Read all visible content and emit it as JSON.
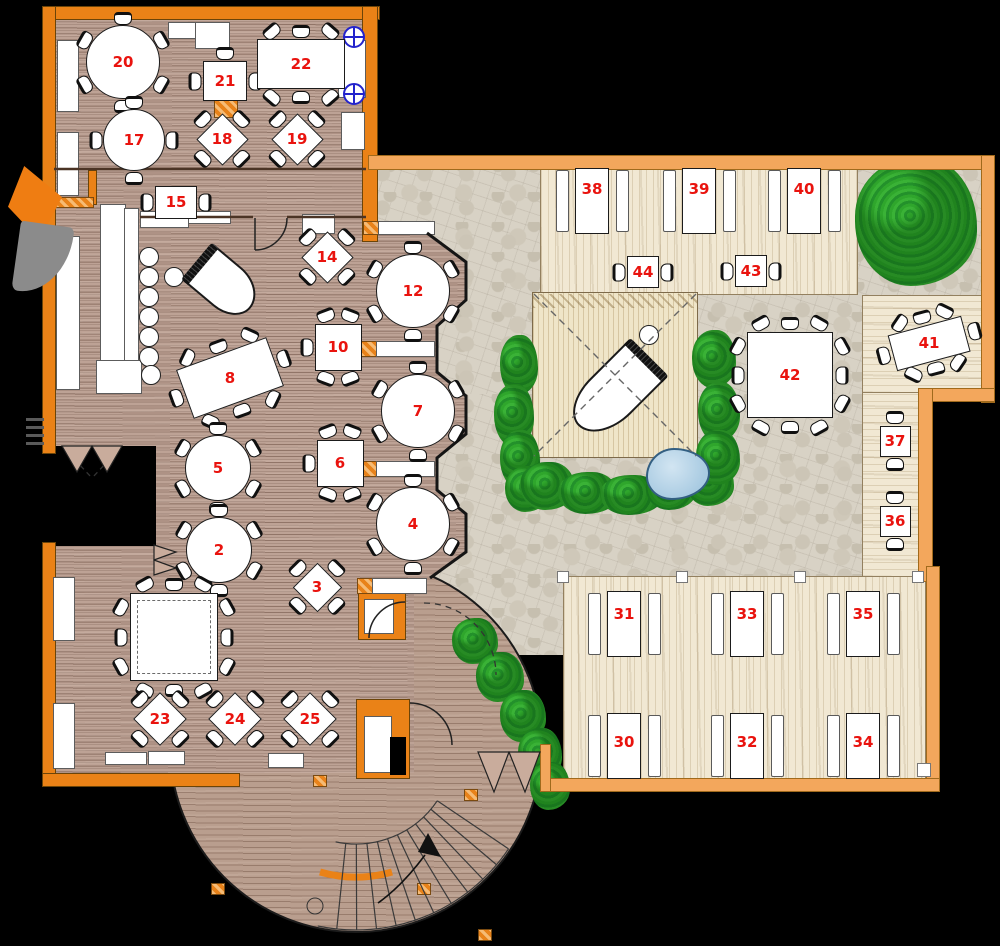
{
  "title": "restaurant-floor-plan",
  "colors": {
    "background": "#000000",
    "wall_orange": "#ea8217",
    "wall_light": "#f3a75c",
    "wood_floor": "#bda295",
    "stone_patio": "#d8d2c5",
    "deck": "#f1e8d3",
    "stage": "#efe5c8",
    "bush_green": "#2fa62c",
    "pond_blue": "#a9cbe2",
    "table_white": "#ffffff",
    "number_red": "#e9130e",
    "symbol_blue": "#2323cc"
  },
  "tables": [
    {
      "n": "20",
      "kind": "round",
      "x": 123,
      "y": 62,
      "r": 37,
      "seats": 6
    },
    {
      "n": "21",
      "kind": "sq",
      "x": 225,
      "y": 81,
      "w": 44,
      "h": 40,
      "chairs": "ew",
      "extra": "n"
    },
    {
      "n": "22",
      "kind": "rect",
      "x": 301,
      "y": 64,
      "w": 88,
      "h": 50,
      "cols": 3,
      "ends": false
    },
    {
      "n": "17",
      "kind": "round",
      "x": 134,
      "y": 140,
      "r": 31,
      "seats": 4
    },
    {
      "n": "18",
      "kind": "diamond",
      "x": 222,
      "y": 139,
      "s": 37
    },
    {
      "n": "19",
      "kind": "diamond",
      "x": 297,
      "y": 139,
      "s": 37
    },
    {
      "n": "15",
      "kind": "sq",
      "x": 176,
      "y": 202,
      "w": 42,
      "h": 33,
      "chairs": "ew"
    },
    {
      "n": "14",
      "kind": "diamond",
      "x": 327,
      "y": 257,
      "s": 37
    },
    {
      "n": "12",
      "kind": "round",
      "x": 413,
      "y": 291,
      "r": 37,
      "seats": 6
    },
    {
      "n": "10",
      "kind": "sq",
      "x": 338,
      "y": 347,
      "w": 47,
      "h": 47,
      "chairs": "5"
    },
    {
      "n": "8",
      "kind": "rect",
      "x": 230,
      "y": 378,
      "w": 96,
      "h": 52,
      "rot": -20,
      "cols": 3,
      "ends": true
    },
    {
      "n": "7",
      "kind": "round",
      "x": 418,
      "y": 411,
      "r": 37,
      "seats": 6
    },
    {
      "n": "6",
      "kind": "sq",
      "x": 340,
      "y": 463,
      "w": 47,
      "h": 47,
      "chairs": "5"
    },
    {
      "n": "5",
      "kind": "round",
      "x": 218,
      "y": 468,
      "r": 33,
      "seats": 6
    },
    {
      "n": "2",
      "kind": "round",
      "x": 219,
      "y": 550,
      "r": 33,
      "seats": 6
    },
    {
      "n": "3",
      "kind": "diamond",
      "x": 317,
      "y": 587,
      "s": 35
    },
    {
      "n": "4",
      "kind": "round",
      "x": 413,
      "y": 524,
      "r": 37,
      "seats": 6
    },
    {
      "n": "",
      "kind": "banquet",
      "x": 174,
      "y": 637,
      "s": 88,
      "dashed": true
    },
    {
      "n": "23",
      "kind": "diamond",
      "x": 160,
      "y": 719,
      "s": 38
    },
    {
      "n": "24",
      "kind": "diamond",
      "x": 235,
      "y": 719,
      "s": 38
    },
    {
      "n": "25",
      "kind": "diamond",
      "x": 310,
      "y": 719,
      "s": 38
    },
    {
      "n": "38",
      "kind": "long",
      "x": 592,
      "y": 201,
      "dy": -12
    },
    {
      "n": "39",
      "kind": "long",
      "x": 699,
      "y": 201,
      "dy": -12
    },
    {
      "n": "40",
      "kind": "long",
      "x": 804,
      "y": 201,
      "dy": -12
    },
    {
      "n": "44",
      "kind": "sq",
      "x": 643,
      "y": 272,
      "w": 32,
      "h": 32,
      "chairs": "ew"
    },
    {
      "n": "43",
      "kind": "sq",
      "x": 751,
      "y": 271,
      "w": 32,
      "h": 32,
      "chairs": "ew"
    },
    {
      "n": "42",
      "kind": "banquet",
      "x": 790,
      "y": 375,
      "s": 86,
      "dashed": false
    },
    {
      "n": "41",
      "kind": "rect",
      "x": 929,
      "y": 343,
      "w": 76,
      "h": 37,
      "rot": -15,
      "cols": 3,
      "ends": true
    },
    {
      "n": "37",
      "kind": "sq",
      "x": 895,
      "y": 441,
      "w": 31,
      "h": 31,
      "chairs": "ns"
    },
    {
      "n": "36",
      "kind": "sq",
      "x": 895,
      "y": 521,
      "w": 31,
      "h": 31,
      "chairs": "ns"
    },
    {
      "n": "31",
      "kind": "long",
      "x": 624,
      "y": 624,
      "dy": -10
    },
    {
      "n": "33",
      "kind": "long",
      "x": 747,
      "y": 624,
      "dy": -10
    },
    {
      "n": "35",
      "kind": "long",
      "x": 863,
      "y": 624,
      "dy": -10
    },
    {
      "n": "30",
      "kind": "long",
      "x": 624,
      "y": 746,
      "dy": -4
    },
    {
      "n": "32",
      "kind": "long",
      "x": 747,
      "y": 746,
      "dy": -4
    },
    {
      "n": "34",
      "kind": "long",
      "x": 863,
      "y": 746,
      "dy": -4
    }
  ],
  "zones": {
    "stone": [
      [
        372,
        162,
        618,
        232
      ],
      [
        372,
        394,
        558,
        184
      ],
      [
        372,
        578,
        196,
        77
      ]
    ],
    "deck_top": [
      540,
      168,
      318,
      127
    ],
    "deck_right_a": [
      862,
      295,
      128,
      99
    ],
    "deck_right_b": [
      862,
      392,
      60,
      186
    ],
    "deck_bottom": [
      563,
      576,
      363,
      203
    ],
    "stage": [
      532,
      292,
      166,
      166
    ],
    "stage_hatch": [
      533,
      294,
      164,
      14
    ],
    "terrace_circle": [
      169,
      559,
      374,
      374
    ],
    "notch": [
      46,
      446,
      110,
      100
    ]
  },
  "furniture": {
    "wall": [
      [
        42,
        6,
        336,
        12
      ],
      [
        42,
        6,
        12,
        446
      ],
      [
        42,
        542,
        12,
        243
      ],
      [
        42,
        773,
        196,
        12
      ],
      [
        362,
        6,
        14,
        234
      ],
      [
        88,
        170,
        7,
        33
      ],
      [
        358,
        592,
        46,
        46
      ],
      [
        356,
        699,
        52,
        78
      ]
    ],
    "wall2": [
      [
        368,
        155,
        625,
        13
      ],
      [
        981,
        155,
        12,
        246
      ],
      [
        918,
        388,
        75,
        12
      ],
      [
        918,
        388,
        13,
        192
      ],
      [
        926,
        566,
        12,
        224
      ],
      [
        548,
        778,
        390,
        12
      ],
      [
        540,
        744,
        9,
        46
      ]
    ],
    "hatch": [
      [
        214,
        98,
        22,
        18
      ],
      [
        54,
        197,
        38,
        9
      ],
      [
        363,
        221,
        15,
        12
      ],
      [
        360,
        341,
        16,
        14
      ],
      [
        360,
        461,
        16,
        14
      ],
      [
        357,
        578,
        15,
        14
      ],
      [
        464,
        789,
        12,
        10
      ],
      [
        313,
        775,
        12,
        10
      ],
      [
        478,
        929,
        12,
        10
      ],
      [
        417,
        883,
        12,
        10
      ],
      [
        211,
        883,
        12,
        10
      ]
    ],
    "wf": [
      [
        57,
        40,
        20,
        70
      ],
      [
        57,
        132,
        20,
        62
      ],
      [
        168,
        22,
        27,
        15
      ],
      [
        195,
        22,
        33,
        25
      ],
      [
        338,
        40,
        26,
        56
      ],
      [
        341,
        112,
        22,
        36
      ],
      [
        140,
        211,
        47,
        15
      ],
      [
        188,
        211,
        41,
        11
      ],
      [
        302,
        214,
        31,
        18
      ],
      [
        378,
        221,
        55,
        12
      ],
      [
        376,
        341,
        57,
        14
      ],
      [
        376,
        461,
        57,
        14
      ],
      [
        372,
        578,
        53,
        14
      ],
      [
        364,
        599,
        28,
        33
      ],
      [
        364,
        716,
        26,
        55
      ],
      [
        53,
        577,
        20,
        62
      ],
      [
        53,
        703,
        20,
        64
      ],
      [
        105,
        752,
        40,
        11
      ],
      [
        148,
        751,
        35,
        12
      ],
      [
        268,
        753,
        34,
        13
      ],
      [
        100,
        204,
        24,
        174
      ],
      [
        124,
        208,
        13,
        168
      ],
      [
        56,
        236,
        22,
        152
      ],
      [
        96,
        360,
        44,
        32
      ]
    ],
    "wp": [
      [
        557,
        571,
        10,
        10
      ],
      [
        676,
        571,
        10,
        10
      ],
      [
        794,
        571,
        10,
        10
      ],
      [
        912,
        571,
        10,
        10
      ],
      [
        917,
        763,
        12,
        12
      ]
    ],
    "bk": [
      [
        390,
        737,
        16,
        38
      ]
    ],
    "vent": [
      [
        26,
        418,
        18,
        3
      ],
      [
        26,
        426,
        18,
        3
      ],
      [
        26,
        434,
        18,
        3
      ],
      [
        26,
        442,
        18,
        3
      ]
    ]
  },
  "stools": [
    [
      148,
      256
    ],
    [
      148,
      276
    ],
    [
      148,
      296
    ],
    [
      148,
      316
    ],
    [
      148,
      336
    ],
    [
      148,
      356
    ],
    [
      150,
      374
    ],
    [
      173,
      276
    ],
    [
      648,
      334
    ]
  ],
  "bushes": [
    [
      855,
      158,
      122,
      128
    ],
    [
      500,
      335,
      38,
      60
    ],
    [
      494,
      384,
      40,
      62
    ],
    [
      500,
      430,
      40,
      58
    ],
    [
      505,
      466,
      44,
      46
    ],
    [
      520,
      462,
      55,
      48
    ],
    [
      558,
      472,
      60,
      42
    ],
    [
      600,
      475,
      62,
      40
    ],
    [
      646,
      468,
      50,
      42
    ],
    [
      686,
      460,
      48,
      46
    ],
    [
      692,
      330,
      44,
      58
    ],
    [
      698,
      382,
      42,
      60
    ],
    [
      696,
      430,
      44,
      55
    ],
    [
      452,
      618,
      46,
      46
    ],
    [
      476,
      652,
      48,
      50
    ],
    [
      500,
      690,
      46,
      52
    ],
    [
      518,
      728,
      44,
      52
    ],
    [
      530,
      762,
      40,
      48
    ]
  ],
  "pond": [
    646,
    448,
    64,
    52
  ],
  "pianos": [
    [
      188,
      260,
      68,
      44,
      40
    ],
    [
      565,
      365,
      95,
      50,
      135
    ]
  ],
  "symbols": [
    [
      343,
      26
    ],
    [
      343,
      83
    ]
  ],
  "entrance": {
    "wedge": [
      8,
      166,
      54,
      74
    ],
    "fan": [
      16,
      224,
      54,
      70
    ]
  }
}
